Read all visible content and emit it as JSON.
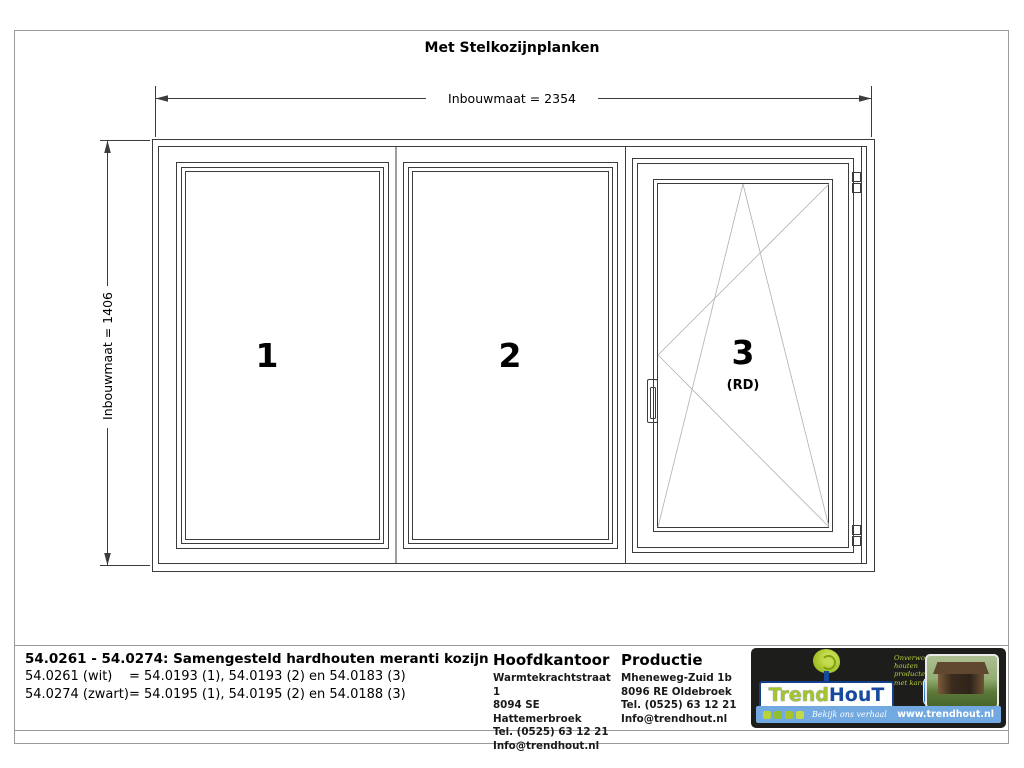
{
  "drawing": {
    "title": "Met Stelkozijnplanken",
    "dim_width_label": "Inbouwmaat = 2354",
    "dim_height_label": "Inbouwmaat = 1406",
    "panels": {
      "p1": "1",
      "p2": "2",
      "p3": "3",
      "p3_sub": "(RD)"
    }
  },
  "titleblock": {
    "heading": "54.0261 - 54.0274: Samengesteld hardhouten meranti kozijn",
    "variant_wit_label": "54.0261 (wit)",
    "variant_wit_value": "= 54.0193 (1), 54.0193 (2) en 54.0183 (3)",
    "variant_zwart_label": "54.0274 (zwart)",
    "variant_zwart_value": "= 54.0195 (1), 54.0195 (2) en 54.0188 (3)",
    "hoofdkantoor": {
      "title": "Hoofdkantoor",
      "address1": "Warmtekrachtstraat 1",
      "address2": "8094 SE Hattemerbroek",
      "tel": "Tel. (0525) 63 12 21",
      "email": "Info@trendhout.nl"
    },
    "productie": {
      "title": "Productie",
      "address1": "Mheneweg-Zuid 1b",
      "address2": "8096 RE Oldebroek",
      "tel": "Tel. (0525) 63 12 21",
      "email": "Info@trendhout.nl"
    }
  },
  "brand": {
    "name_part1": "Trend",
    "name_part2": "HouT",
    "tagline1": "Onverwoestbare",
    "tagline2": "houten producten",
    "tagline3": "met karakter",
    "badge": "3D",
    "cta": "Bekijk ons verhaal",
    "website": "www.trendhout.nl"
  },
  "colors": {
    "line": "#3c3c3c",
    "symbol_line": "#b0b0b0",
    "lime": "#a6c52c",
    "brand_blue": "#17499c",
    "bar_blue": "#71a9e0",
    "panel_bg": "#1d1d1b"
  }
}
